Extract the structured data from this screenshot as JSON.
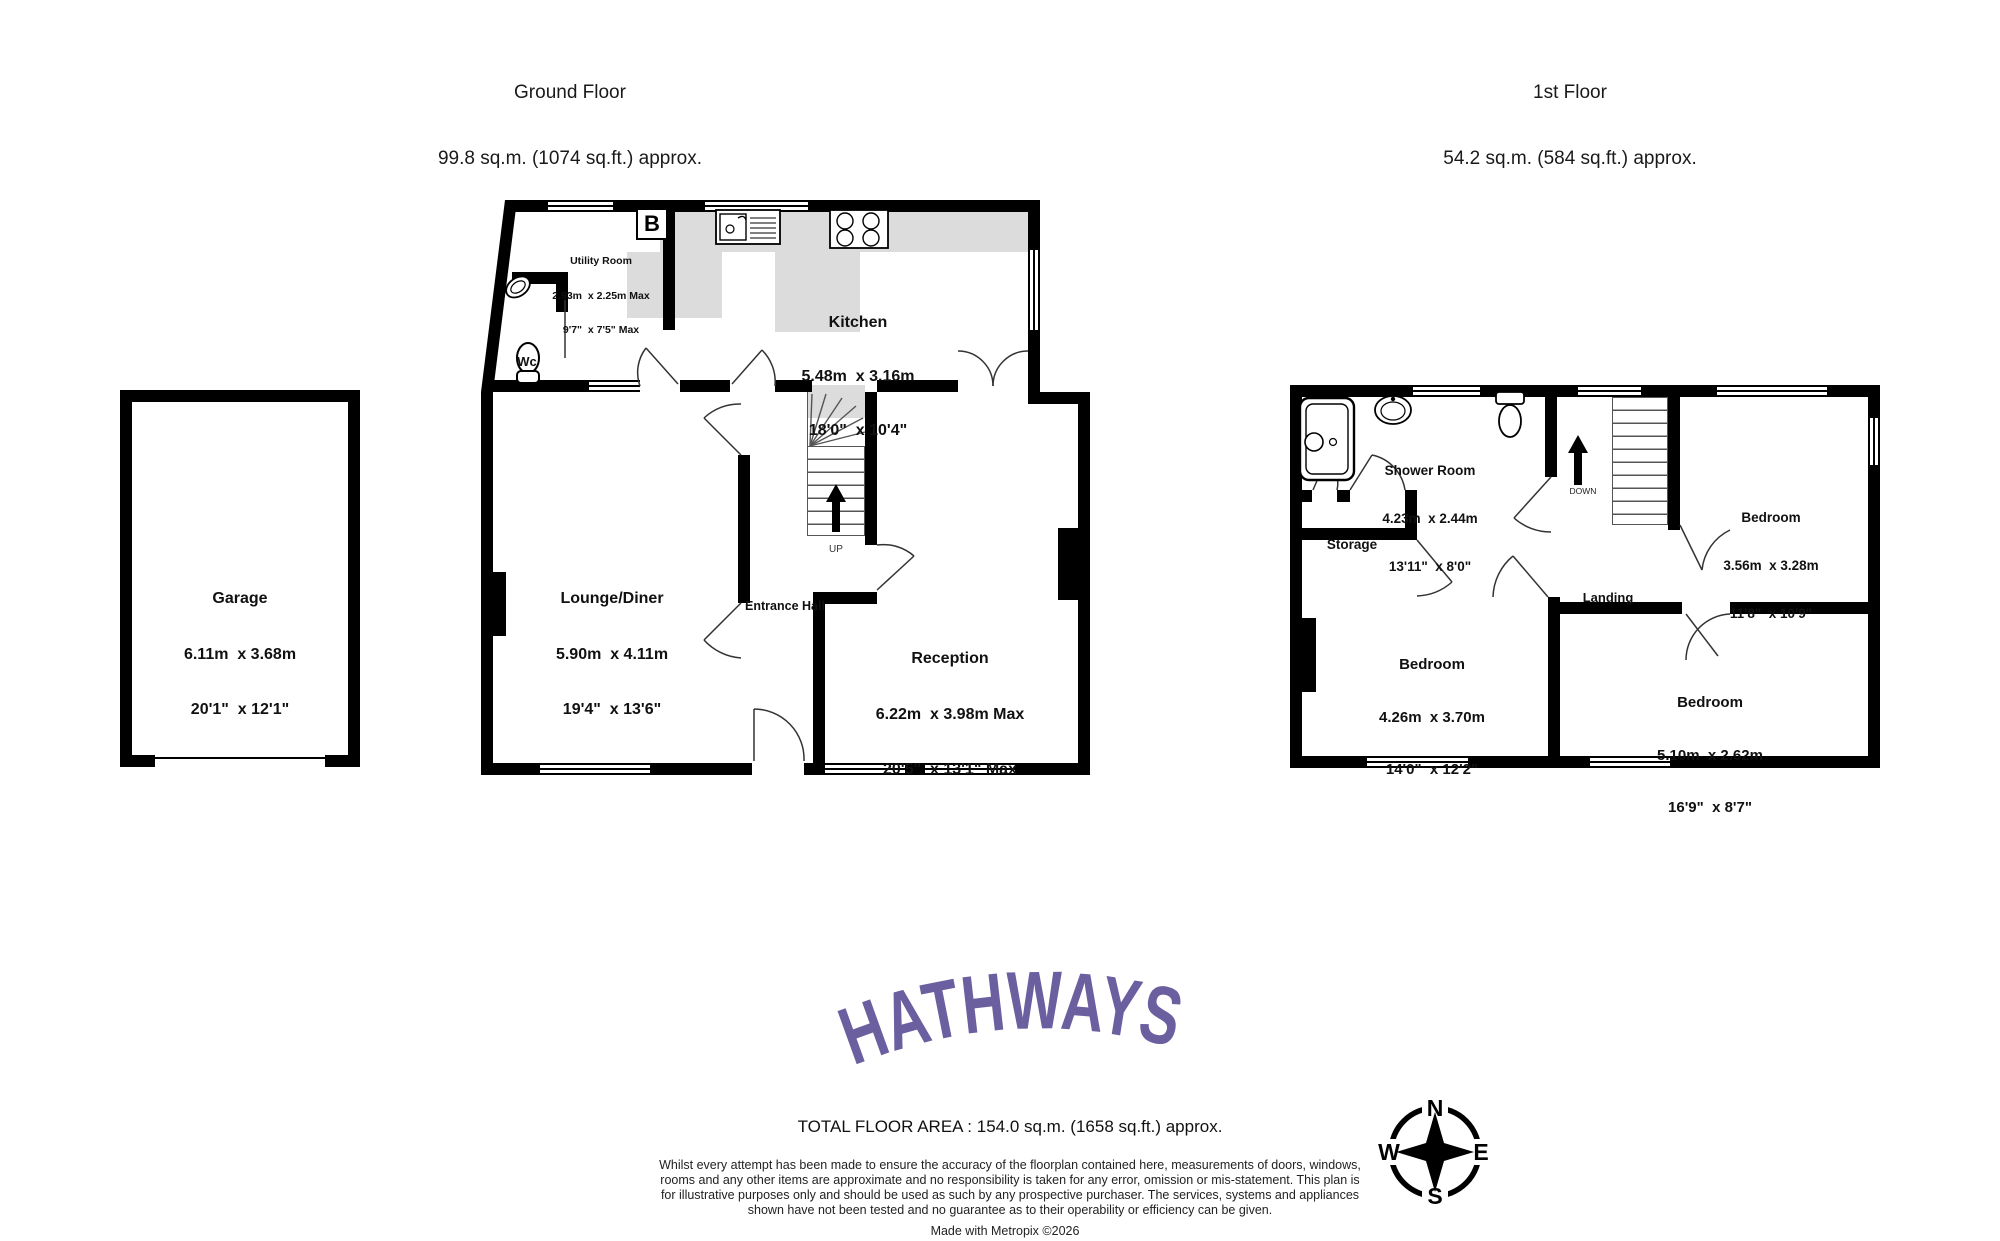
{
  "floors": {
    "ground": {
      "title": "Ground Floor",
      "area": "99.8 sq.m. (1074 sq.ft.) approx."
    },
    "first": {
      "title": "1st Floor",
      "area": "54.2 sq.m. (584 sq.ft.) approx."
    }
  },
  "rooms": {
    "garage": {
      "name": "Garage",
      "metric": "6.11m  x 3.68m",
      "imperial": "20'1\"  x 12'1\""
    },
    "utility": {
      "name": "Utility Room",
      "metric": "2.93m  x 2.25m Max",
      "imperial": "9'7\"  x 7'5\" Max"
    },
    "kitchen": {
      "name": "Kitchen",
      "metric": "5.48m  x 3.16m",
      "imperial": "18'0\"  x 10'4\""
    },
    "wc": {
      "name": "Wc"
    },
    "lounge": {
      "name": "Lounge/Diner",
      "metric": "5.90m  x 4.11m",
      "imperial": "19'4\"  x 13'6\""
    },
    "hall": {
      "name": "Entrance Hall"
    },
    "reception": {
      "name": "Reception",
      "metric": "6.22m  x 3.98m Max",
      "imperial": "20'5\"  x 13'1\" Max"
    },
    "shower": {
      "name": "Shower Room",
      "metric": "4.23m  x 2.44m",
      "imperial": "13'11\"  x 8'0\""
    },
    "storage": {
      "name": "Storage"
    },
    "landing": {
      "name": "Landing"
    },
    "bed_top_right": {
      "name": "Bedroom",
      "metric": "3.56m  x 3.28m",
      "imperial": "11'8\"  x 10'9\""
    },
    "bed_left": {
      "name": "Bedroom",
      "metric": "4.26m  x 3.70m",
      "imperial": "14'0\"  x 12'2\""
    },
    "bed_bottom_right": {
      "name": "Bedroom",
      "metric": "5.10m  x 2.62m",
      "imperial": "16'9\"  x 8'7\""
    }
  },
  "stairs": {
    "up_label": "UP",
    "down_label": "DOWN"
  },
  "boiler_label": "B",
  "logo": {
    "text": "HATHWAYS",
    "color": "#6B5FA0"
  },
  "footer": {
    "total": "TOTAL FLOOR AREA : 154.0 sq.m. (1658 sq.ft.) approx.",
    "disclaimer": "Whilst every attempt has been made to ensure the accuracy of the floorplan contained here, measurements of doors, windows, rooms and any other items are approximate and no responsibility is taken for any error, omission or mis-statement. This plan is for illustrative purposes only and should be used as such by any prospective purchaser. The services, systems and appliances shown have not been tested and no guarantee as to their operability or efficiency can be given.",
    "credit": "Made with Metropix ©2026"
  },
  "compass": {
    "n": "N",
    "e": "E",
    "s": "S",
    "w": "W"
  }
}
